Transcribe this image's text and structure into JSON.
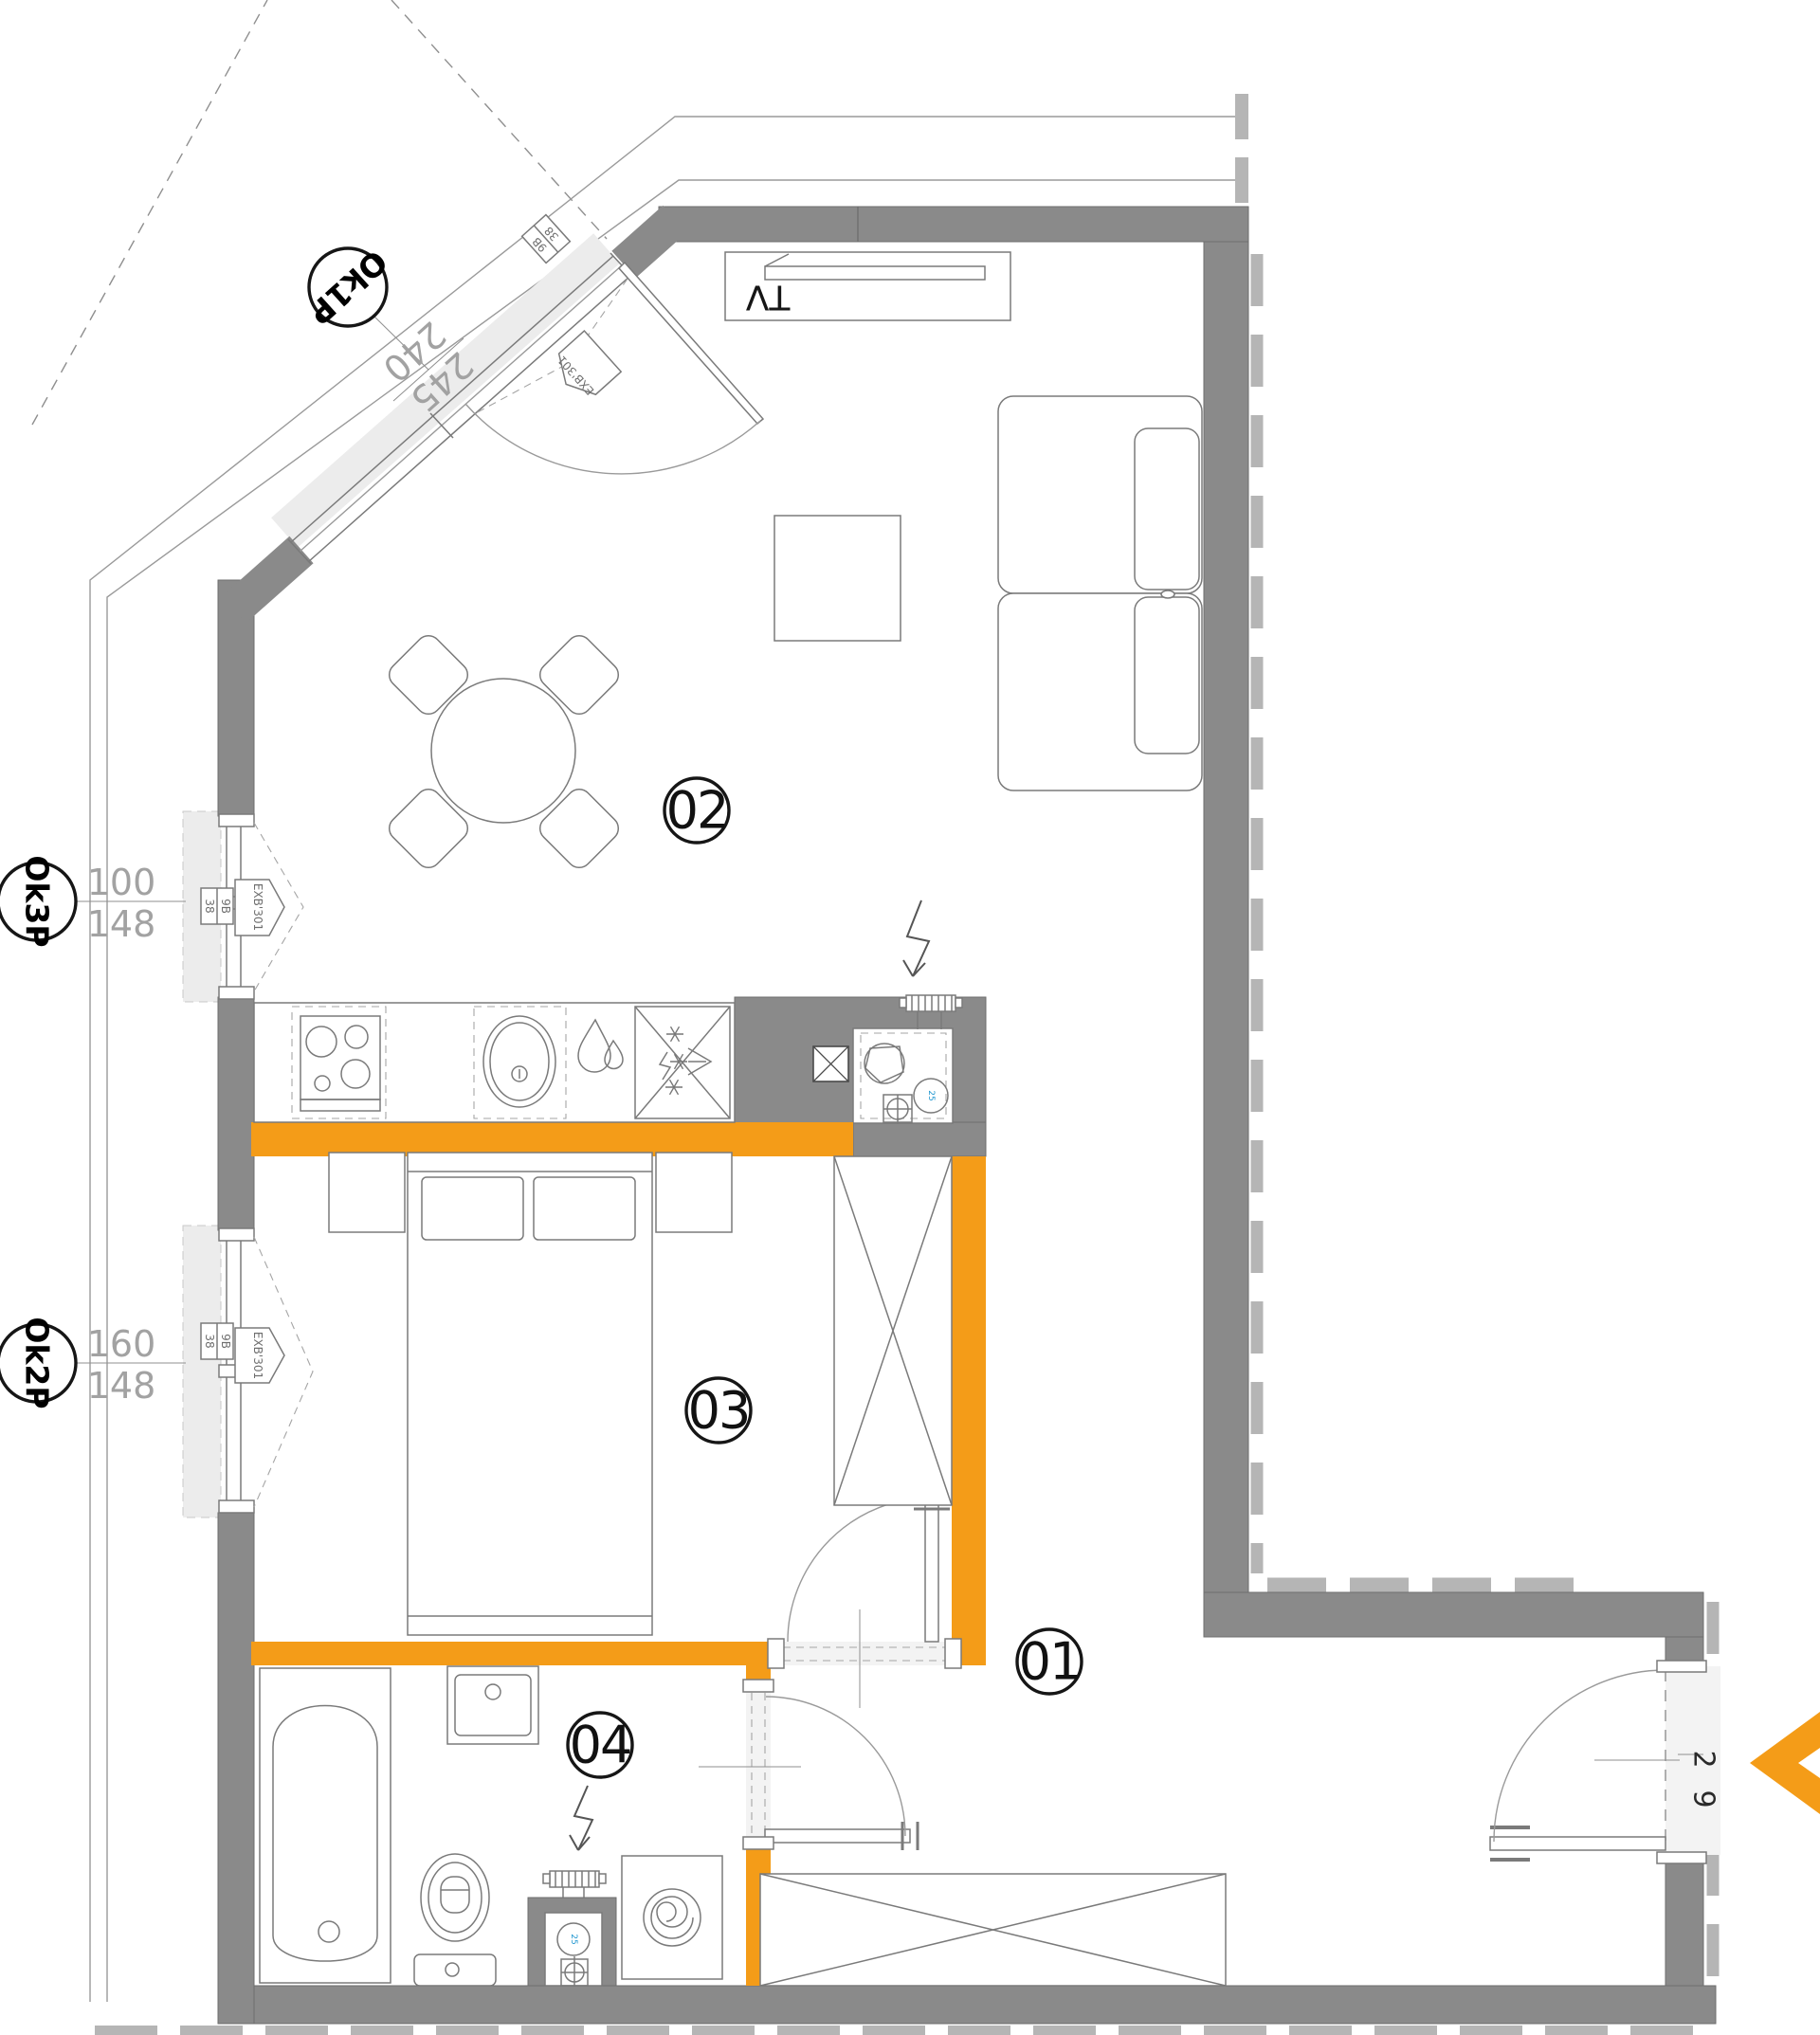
{
  "colors": {
    "wall": "#8a8a8a",
    "wall_dash": "#b5b5b5",
    "accent_orange": "#f49c18",
    "sill_gray": "#ececec",
    "duct_blue": "#1f96cf"
  },
  "rooms": [
    {
      "id": "01"
    },
    {
      "id": "02"
    },
    {
      "id": "03"
    },
    {
      "id": "04"
    }
  ],
  "window_tags": [
    {
      "tag": "Ok1P",
      "dim_width": "240",
      "dim_height": "245"
    },
    {
      "tag": "Ok3P",
      "dim_width": "100",
      "dim_height": "148"
    },
    {
      "tag": "Ok2P",
      "dim_width": "160",
      "dim_height": "148"
    }
  ],
  "labels": {
    "tv": "TV",
    "window_system": "EXB'301",
    "meter_left": "38",
    "meter_right": "9B",
    "duct": "25",
    "entrance_dim_top": "2",
    "entrance_dim_bottom": "9"
  }
}
